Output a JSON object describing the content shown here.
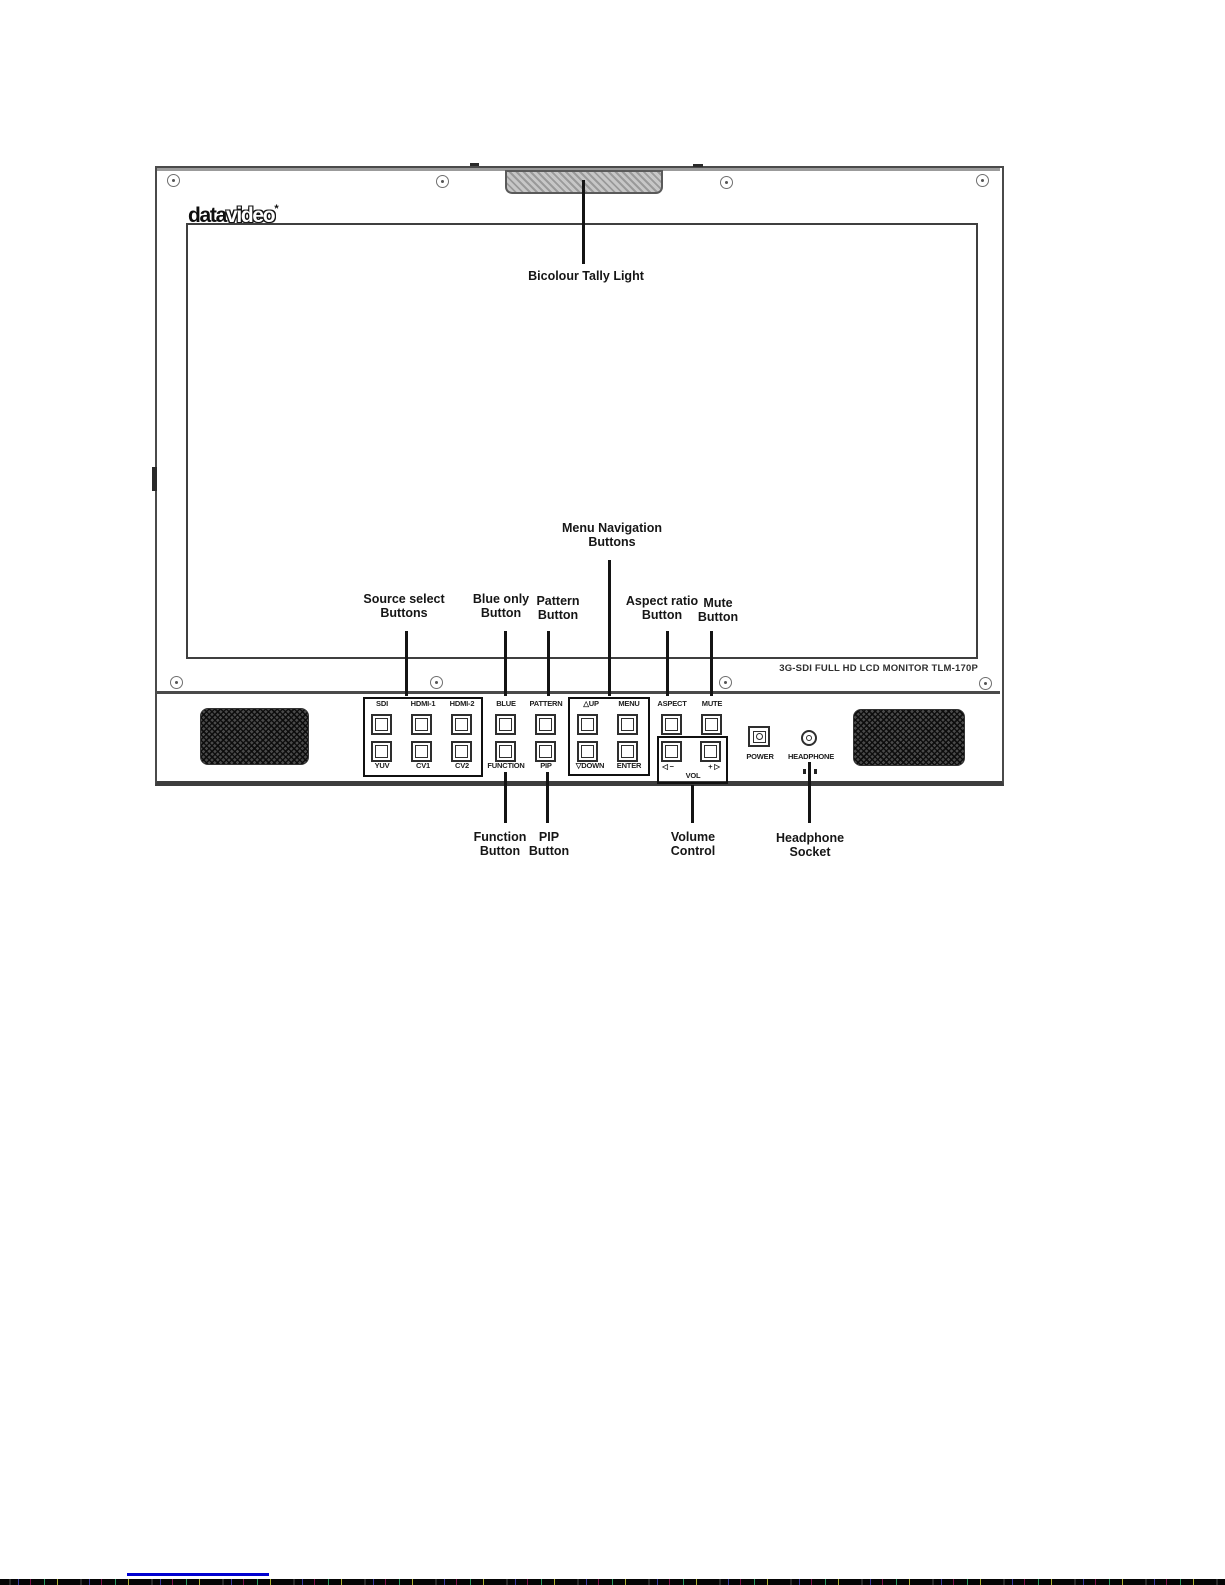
{
  "monitor": {
    "brand": {
      "part1": "data",
      "part2": "video",
      "mark": "*"
    },
    "model_text": "3G-SDI FULL HD LCD MONITOR TLM-170P",
    "panel": {
      "labels": {
        "sdi": "SDI",
        "hdmi1": "HDMI-1",
        "hdmi2": "HDMI-2",
        "yuv": "YUV",
        "cv1": "CV1",
        "cv2": "CV2",
        "blue": "BLUE",
        "pattern": "PATTERN",
        "function": "FUNCTION",
        "pip": "PIP",
        "up": "△UP",
        "menu": "MENU",
        "down": "▽DOWN",
        "enter": "ENTER",
        "aspect": "ASPECT",
        "mute": "MUTE",
        "vol": "VOL",
        "vol_minus": "◁ −",
        "vol_plus": "+ ▷",
        "power": "POWER",
        "headphone": "HEADPHONE"
      }
    }
  },
  "annotations": {
    "tally": {
      "text": "Bicolour Tally Light"
    },
    "menu_nav": {
      "line1": "Menu Navigation",
      "line2": "Buttons"
    },
    "source_select": {
      "line1": "Source select",
      "line2": "Buttons"
    },
    "blue_only": {
      "line1": "Blue only",
      "line2": "Button"
    },
    "pattern": {
      "line1": "Pattern",
      "line2": "Button"
    },
    "aspect": {
      "line1": "Aspect ratio",
      "line2": "Button"
    },
    "mute": {
      "line1": "Mute",
      "line2": "Button"
    },
    "function": {
      "line1": "Function",
      "line2": "Button"
    },
    "pip": {
      "line1": "PIP",
      "line2": "Button"
    },
    "volume": {
      "line1": "Volume",
      "line2": "Control"
    },
    "headphone": {
      "line1": "Headphone",
      "line2": "Socket"
    }
  },
  "colors": {
    "line_art": "#141414",
    "artifact_blue": "#0000d0",
    "tally_fill": "#bdbdbd"
  }
}
